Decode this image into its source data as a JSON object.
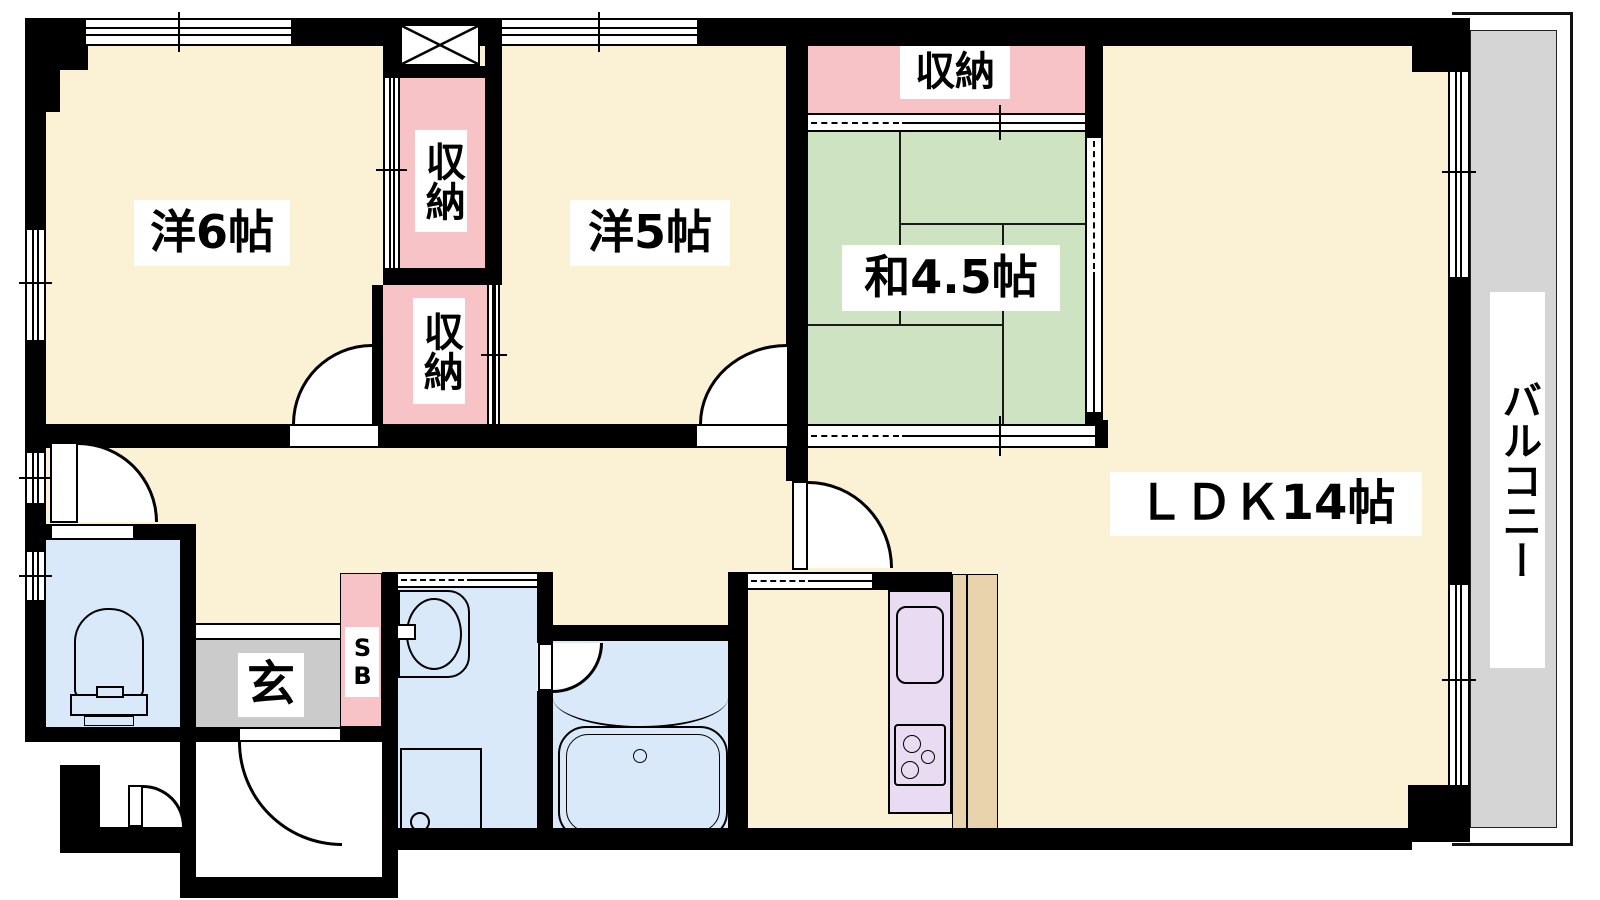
{
  "title": "2LDK+S apartment floor plan",
  "rooms": {
    "western6": {
      "label": "洋6帖"
    },
    "western5": {
      "label": "洋5帖"
    },
    "japanese45": {
      "label": "和4.5帖"
    },
    "ldk": {
      "label": "ＬＤＫ14帖"
    },
    "closet_top": {
      "label": "収納"
    },
    "closet_upper": {
      "label": "収納"
    },
    "closet_lower": {
      "label": "収納"
    },
    "balcony": {
      "label": "バルコニー"
    },
    "entrance": {
      "label": "玄"
    },
    "shoebox": {
      "label": "SB"
    }
  },
  "colors": {
    "cream": "#FBF1D5",
    "pink": "#F8C3C7",
    "green": "#CDE3C1",
    "blue": "#D9E9FA",
    "gray": "#CBCBCB",
    "balcony_gray": "#D5D5D5",
    "purple": "#E8DBF2",
    "tan": "#E9D3AC",
    "wall": "#000000"
  }
}
